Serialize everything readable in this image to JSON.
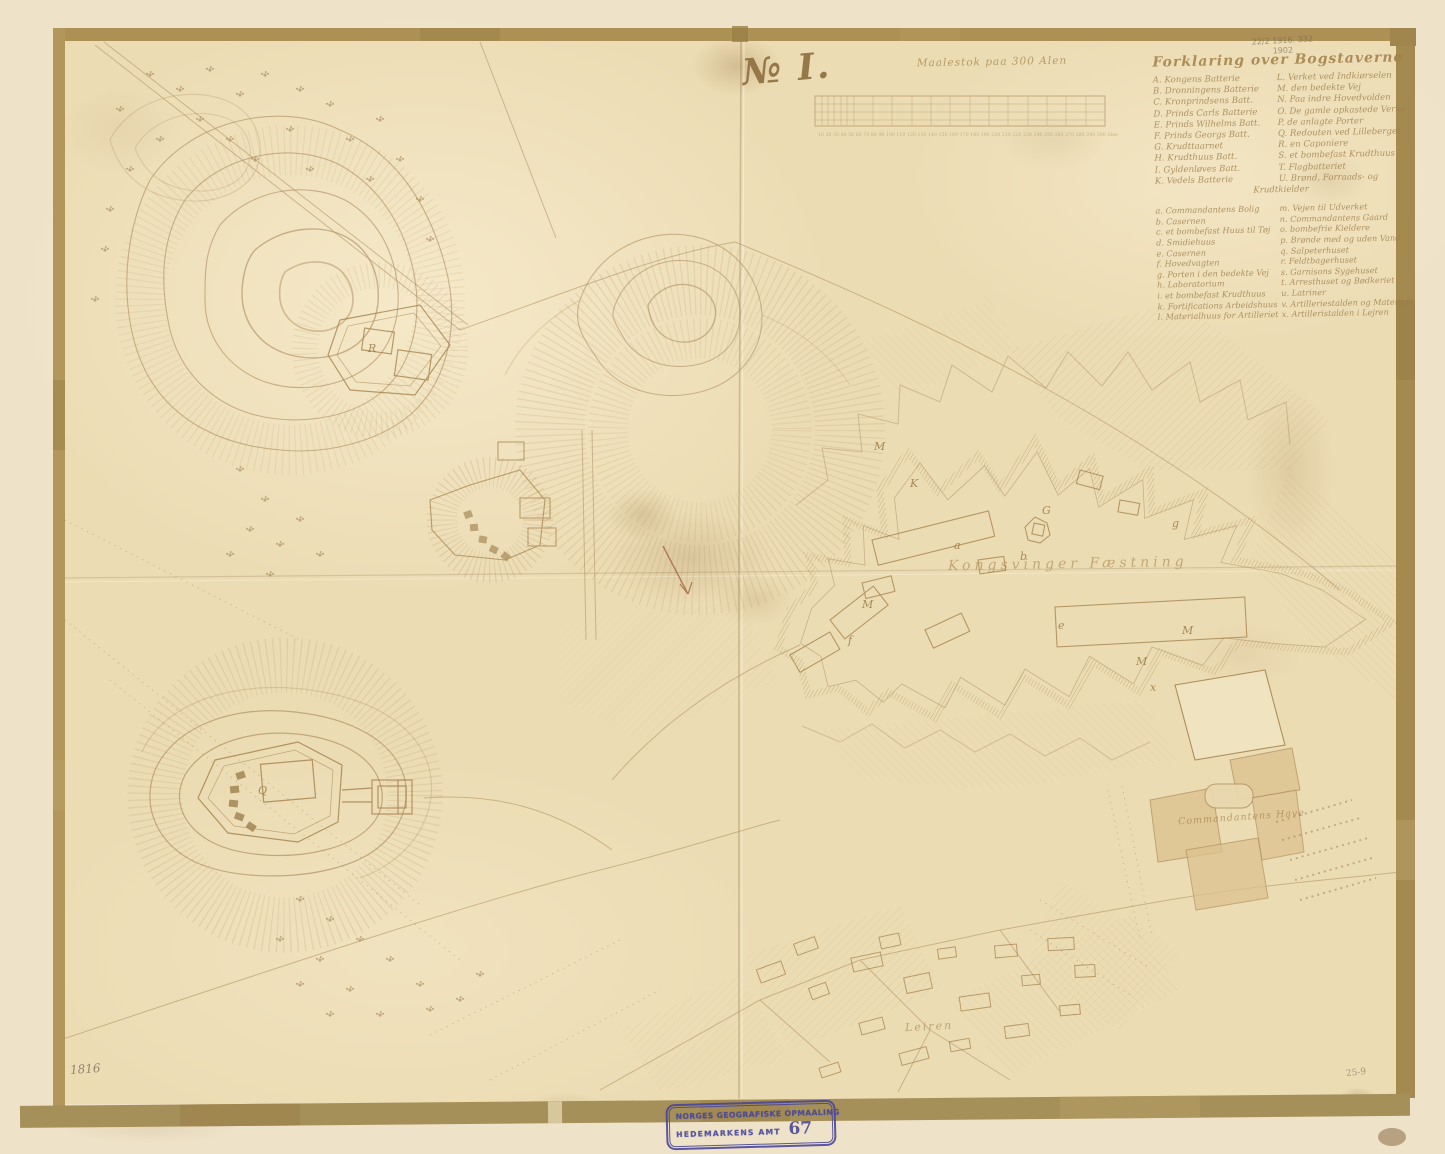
{
  "map": {
    "title": "№ I.",
    "scale_label": "Maalestok paa 300 Alen",
    "scale_ticks": "10 20 30 40 50 60 70 80 90 100 110 120 130 140 150 160 170 180 190 200 210 220 230 240 250 260 270 280 290 300 Alen",
    "center_label": "Kongsvinger Fæstning",
    "garden_label": "Commandantens Have",
    "town_label": "Leiren",
    "date_note": "1816",
    "corner_note": "25-9",
    "pencil_note1": "22/2 1916. 332",
    "pencil_note2": "1902"
  },
  "legend": {
    "title": "Forklaring over Bogstaverne",
    "upper": [
      {
        "l": "A. Kongens Batterie",
        "r": "L. Verket ved Indkiørselen"
      },
      {
        "l": "B. Dronningens Batterie",
        "r": "M. den bedekte Vej"
      },
      {
        "l": "C. Kronprindsens Batt.",
        "r": "N. Paa indre Hovedvolden"
      },
      {
        "l": "D. Prinds Carls Batterie",
        "r": "O. De gamle opkastede Verker"
      },
      {
        "l": "E. Prinds Wilhelms Batt.",
        "r": "P. de anlagte Porter"
      },
      {
        "l": "F. Prinds Georgs Batt.",
        "r": "Q. Redouten ved Lilleberget"
      },
      {
        "l": "G. Krudttaarnet",
        "r": "R. en Caponiere"
      },
      {
        "l": "H. Krudthuus Batt.",
        "r": "S. et bombefast Krudthuus"
      },
      {
        "l": "I. Gyldenløves Batt.",
        "r": "T. Flagbatteriet"
      },
      {
        "l": "K. Vedels Batterie",
        "r": "U. Brønd, Forraads- og"
      }
    ],
    "cont": "Krudtkielder",
    "lower": [
      {
        "l": "a. Commandantens Bolig",
        "r": "m. Vejen til Udverket"
      },
      {
        "l": "b. Casernen",
        "r": "n. Commandantens Gaard"
      },
      {
        "l": "c. et bombefast Huus til Tøj",
        "r": "o. bombefrie Kieldere"
      },
      {
        "l": "d. Smidiehuus",
        "r": "p. Brønde med og uden Vand"
      },
      {
        "l": "e. Casernen",
        "r": "q. Salpeterhuset"
      },
      {
        "l": "f. Hovedvagten",
        "r": "r. Feldtbagerhuset"
      },
      {
        "l": "g. Porten i den bedekte Vej",
        "r": "s. Garnisons Sygehuset"
      },
      {
        "l": "h. Laboratorium",
        "r": "t. Arresthuset og Bødkeriet"
      },
      {
        "l": "i. et bombefast Krudthuus",
        "r": "u. Latriner"
      },
      {
        "l": "k. Fortifications Arbeidshuus",
        "r": "v. Artilleriestalden og Materialh."
      },
      {
        "l": "l. Materialhuus for Artilleriet",
        "r": "x. Artilleristalden i Lejren"
      }
    ]
  },
  "fort_labels": [
    "R",
    "Q",
    "K",
    "G",
    "b",
    "a",
    "M",
    "e",
    "M",
    "M",
    "x",
    "f",
    "M",
    "g"
  ],
  "stamp": {
    "line1": "NORGES GEOGRAFISKE OPMAALING",
    "line2": "HEDEMARKENS AMT",
    "number": "67"
  },
  "colors": {
    "paper": "#ecdcb4",
    "margin_paper": "#eee2c8",
    "tape": "#ac9054",
    "ink": "#a8854f",
    "stamp_blue": "#45449a"
  }
}
